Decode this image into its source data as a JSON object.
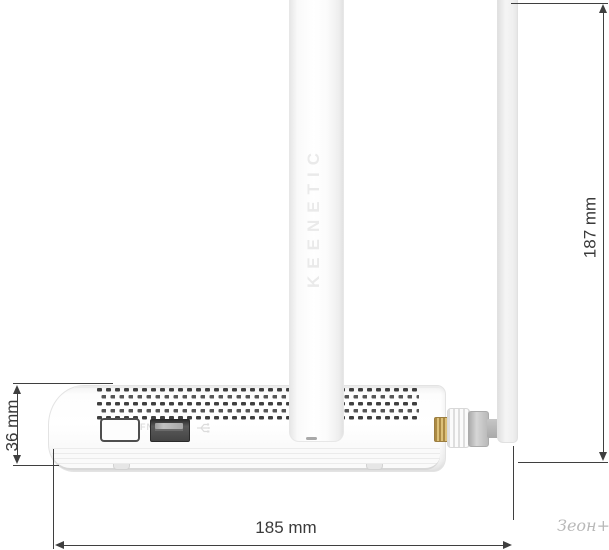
{
  "product": {
    "brand_embossed": "KEENETIC",
    "fn_button_label": "FN"
  },
  "dimensions": {
    "width": "185 mm",
    "height": "36 mm",
    "antenna_height": "187 mm"
  },
  "watermark": "Зеон+",
  "colors": {
    "dimension_line": "#3f3f3f",
    "vent_hole": "#3f3f3f",
    "connector_gold": "#c3a45c",
    "connector_gray": "#bcbcbc",
    "watermark_gray": "#b8b8b8",
    "body_white": "#fbfbfb"
  }
}
